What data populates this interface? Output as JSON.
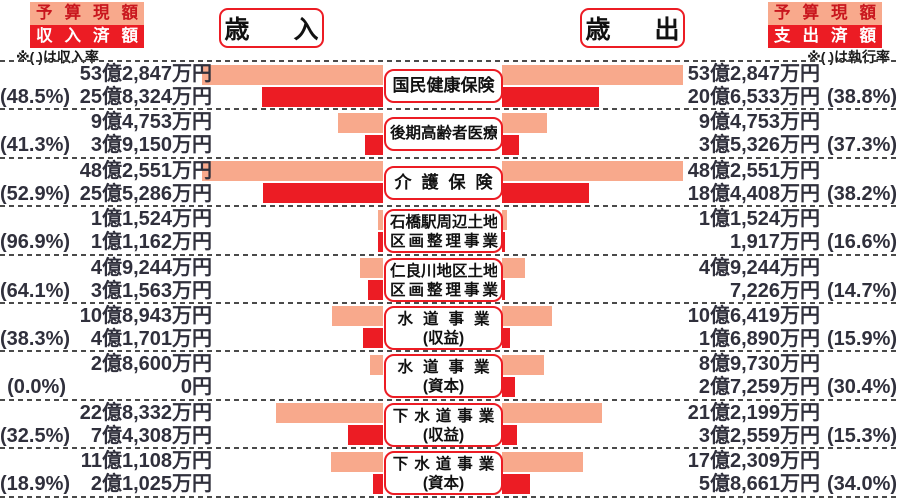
{
  "colors": {
    "pink": "#F8A98C",
    "red": "#EC1C24",
    "dark_red_text": "#C9171E",
    "text": "#30303C"
  },
  "header": {
    "revenue_title": "歳入",
    "expense_title": "歳出",
    "left_legend": {
      "line1": "予算現額",
      "line2": "収入済額",
      "note": "※( )は収入率"
    },
    "right_legend": {
      "line1": "予算現額",
      "line2": "支出済額",
      "note": "※( )は執行率"
    }
  },
  "chart_data": {
    "type": "bar",
    "orientation": "bidirectional-horizontal",
    "unit": "円",
    "left_side": "歳入（予算現額・収入済額）",
    "right_side": "歳出（予算現額・支出済額）",
    "legend": [
      "予算現額",
      "収入済額/支出済額"
    ],
    "scale_px_per_oku": 4.7,
    "max_bar_px": 181,
    "rows": [
      {
        "label_lines": [
          "国民健康保険"
        ],
        "revenue": {
          "budget_text": "53億2,847万円",
          "budget_oku": 53.2847,
          "rate_text": "(48.5%)",
          "received_text": "25億8,324万円",
          "received_oku": 25.8324
        },
        "expense": {
          "budget_text": "53億2,847万円",
          "budget_oku": 53.2847,
          "spent_text": "20億6,533万円",
          "spent_oku": 20.6533,
          "rate_text": "(38.8%)"
        }
      },
      {
        "label_lines": [
          "後期高齢者医療"
        ],
        "revenue": {
          "budget_text": "9億4,753万円",
          "budget_oku": 9.4753,
          "rate_text": "(41.3%)",
          "received_text": "3億9,150万円",
          "received_oku": 3.915
        },
        "expense": {
          "budget_text": "9億4,753万円",
          "budget_oku": 9.4753,
          "spent_text": "3億5,326万円",
          "spent_oku": 3.5326,
          "rate_text": "(37.3%)"
        }
      },
      {
        "label_lines": [
          "介護保険"
        ],
        "revenue": {
          "budget_text": "48億2,551万円",
          "budget_oku": 48.2551,
          "rate_text": "(52.9%)",
          "received_text": "25億5,286万円",
          "received_oku": 25.5286
        },
        "expense": {
          "budget_text": "48億2,551万円",
          "budget_oku": 48.2551,
          "spent_text": "18億4,408万円",
          "spent_oku": 18.4408,
          "rate_text": "(38.2%)"
        }
      },
      {
        "label_lines": [
          "石橋駅周辺土地",
          "区画整理事業"
        ],
        "revenue": {
          "budget_text": "1億1,524万円",
          "budget_oku": 1.1524,
          "rate_text": "(96.9%)",
          "received_text": "1億1,162万円",
          "received_oku": 1.1162
        },
        "expense": {
          "budget_text": "1億1,524万円",
          "budget_oku": 1.1524,
          "spent_text": "1,917万円",
          "spent_oku": 0.1917,
          "rate_text": "(16.6%)"
        }
      },
      {
        "label_lines": [
          "仁良川地区土地",
          "区画整理事業"
        ],
        "revenue": {
          "budget_text": "4億9,244万円",
          "budget_oku": 4.9244,
          "rate_text": "(64.1%)",
          "received_text": "3億1,563万円",
          "received_oku": 3.1563
        },
        "expense": {
          "budget_text": "4億9,244万円",
          "budget_oku": 4.9244,
          "spent_text": "7,226万円",
          "spent_oku": 0.7226,
          "rate_text": "(14.7%)"
        }
      },
      {
        "label_lines": [
          "水道事業",
          "(収益)"
        ],
        "revenue": {
          "budget_text": "10億8,943万円",
          "budget_oku": 10.8943,
          "rate_text": "(38.3%)",
          "received_text": "4億1,701万円",
          "received_oku": 4.1701
        },
        "expense": {
          "budget_text": "10億6,419万円",
          "budget_oku": 10.6419,
          "spent_text": "1億6,890万円",
          "spent_oku": 1.689,
          "rate_text": "(15.9%)"
        }
      },
      {
        "label_lines": [
          "水道事業",
          "(資本)"
        ],
        "revenue": {
          "budget_text": "2億8,600万円",
          "budget_oku": 2.86,
          "rate_text": "(0.0%)",
          "received_text": "0円",
          "received_oku": 0
        },
        "expense": {
          "budget_text": "8億9,730万円",
          "budget_oku": 8.973,
          "spent_text": "2億7,259万円",
          "spent_oku": 2.7259,
          "rate_text": "(30.4%)"
        }
      },
      {
        "label_lines": [
          "下水道事業",
          "(収益)"
        ],
        "revenue": {
          "budget_text": "22億8,332万円",
          "budget_oku": 22.8332,
          "rate_text": "(32.5%)",
          "received_text": "7億4,308万円",
          "received_oku": 7.4308
        },
        "expense": {
          "budget_text": "21億2,199万円",
          "budget_oku": 21.2199,
          "spent_text": "3億2,559万円",
          "spent_oku": 3.2559,
          "rate_text": "(15.3%)"
        }
      },
      {
        "label_lines": [
          "下水道事業",
          "(資本)"
        ],
        "revenue": {
          "budget_text": "11億1,108万円",
          "budget_oku": 11.1108,
          "rate_text": "(18.9%)",
          "received_text": "2億1,025万円",
          "received_oku": 2.1025
        },
        "expense": {
          "budget_text": "17億2,309万円",
          "budget_oku": 17.2309,
          "spent_text": "5億8,661万円",
          "spent_oku": 5.8661,
          "rate_text": "(34.0%)"
        }
      }
    ]
  }
}
